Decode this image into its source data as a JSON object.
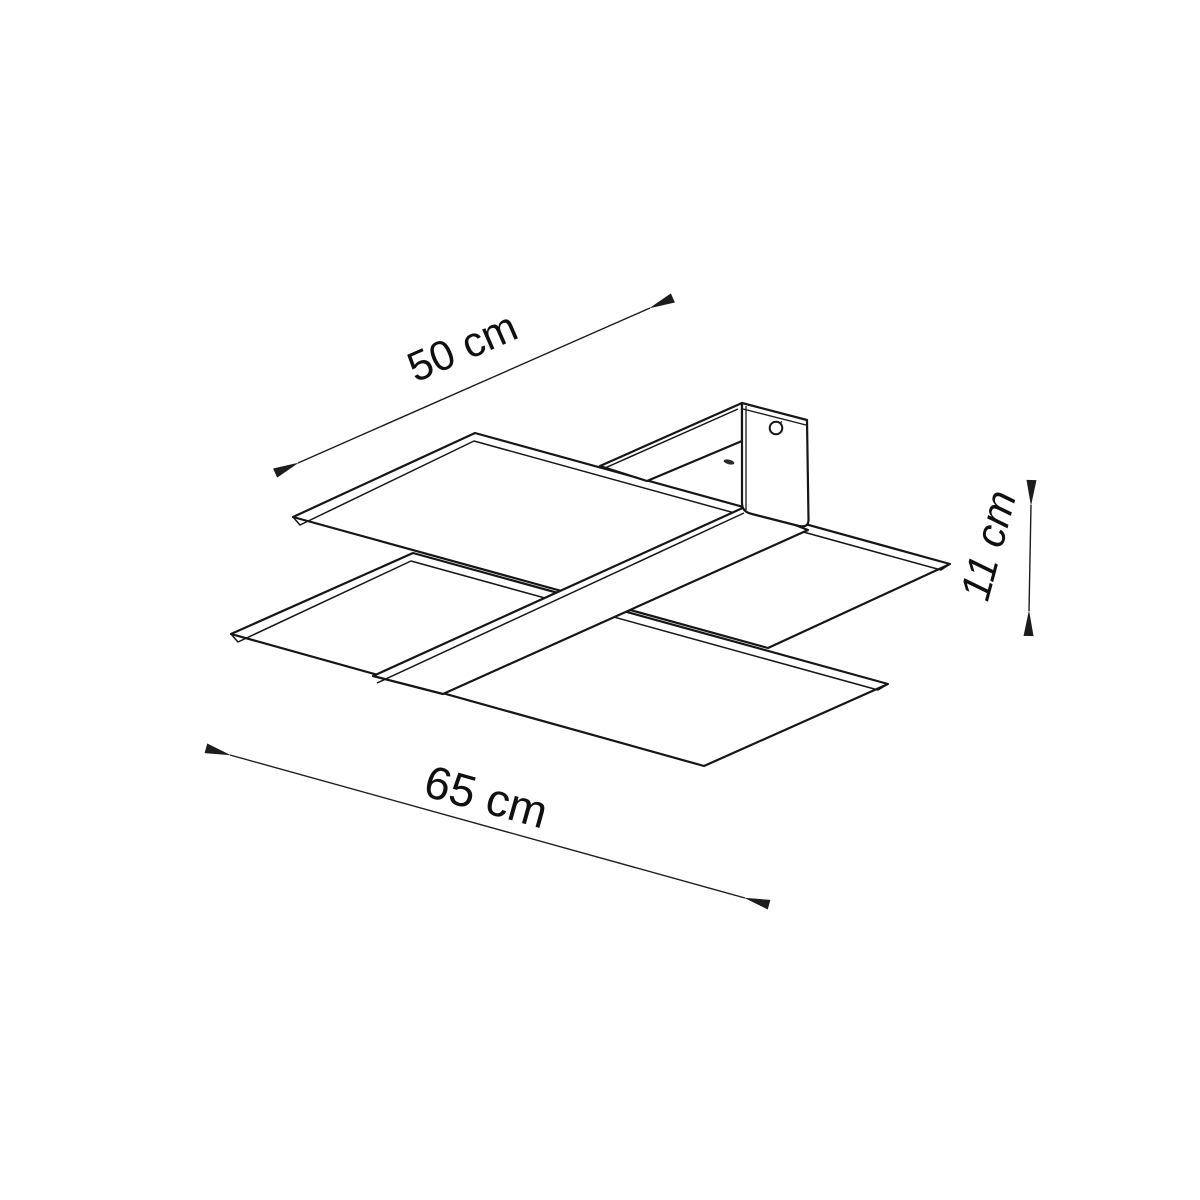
{
  "page": {
    "background": "#ffffff"
  },
  "drawing": {
    "kind": "isometric-dimension-drawing",
    "object": "ceiling-lamp-two-glass-panels-with-cross-strip-and-mount",
    "line_color": "#161616",
    "text_color": "#101010"
  },
  "dimensions": [
    {
      "id": "depth",
      "label": "50 cm"
    },
    {
      "id": "width",
      "label": "65 cm"
    },
    {
      "id": "height",
      "label": "11 cm"
    }
  ]
}
